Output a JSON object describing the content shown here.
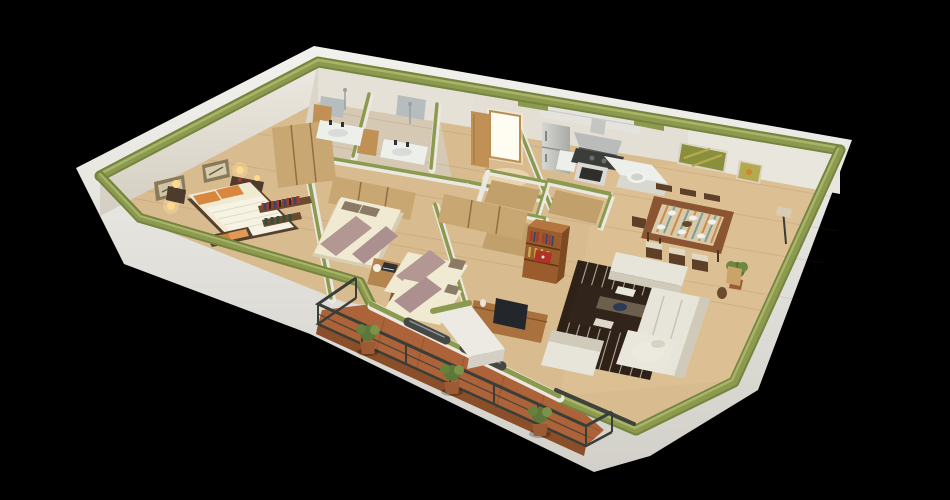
{
  "meta": {
    "description": "Photorealistic 3D isometric cutaway floor-plan rendering of a three-bedroom apartment viewed from above the south-west corner",
    "image_type": "3d-floorplan-render",
    "background": "solid black",
    "wall_treatment": "cut wall tops painted olive green, white wall faces, white plinth skirt around the slab",
    "visible_text": "none"
  },
  "palette": {
    "background": "#000000",
    "skirt_white": "#eae9e4",
    "skirt_shadow": "#d5d3cc",
    "wall_white": "#ebe8e1",
    "wall_face": "#e2ded3",
    "wall_top_green": "#8b9a4f",
    "wall_top_green_dark": "#75843e",
    "wall_top_green_light": "#a9b468",
    "floor_wood": "#d8bc90",
    "floor_wood_dining": "#e3c99e",
    "bath_floor": "#d5c9b4",
    "balcony_tile": "#ad6339",
    "balcony_tile_edge": "#8a4e28",
    "railing_metal": "#3a3e39",
    "rug_dark": "#2d2118",
    "rug_stripe": "#c9bda6",
    "sofa_white": "#e7e4da",
    "sofa_shadow": "#cfcaba",
    "coffee_table": "#31241a",
    "bookshelf_wood": "#9a5c2c",
    "sideboard_wood": "#a8713d",
    "tv_screen": "#23262b",
    "bed_mattress": "#f0ead2",
    "duvet_white": "#f7f3e4",
    "bed_throw_mauve": "#b29792",
    "pillow_orange": "#d8873e",
    "headboard_dark": "#55412f",
    "wardrobe_wood": "#c9a772",
    "wardrobe_trim": "#8f6f45",
    "desk_wood": "#b5854f",
    "door_wood": "#c09055",
    "door_glow": "#fffdf2",
    "appliance_steel": "#c9cac6",
    "appliance_dark": "#3b3d3a",
    "counter_white": "#edefeb",
    "mirror_gray": "#b6bdbf",
    "dining_table_wood": "#8a5530",
    "runner_cream": "#d9c9a8",
    "chair_seat": "#e2d9c2",
    "chair_wood": "#5d4027",
    "painting_green": "#8a8f3e",
    "painting_olive": "#b5a94f",
    "plant_green": "#5c7737",
    "plant_pot": "#9c5a35",
    "lamp_glow": "#ffd98f"
  },
  "rooms": [
    {
      "id": "master-bedroom",
      "name": "Master bedroom",
      "position": "upper left",
      "furniture": [
        "double bed with ribbed white duvet",
        "two orange pillows",
        "dark headboard",
        "bench with orange cushions at bed foot",
        "nightstand with lamp",
        "dresser with red books and lamp",
        "two framed pictures",
        "two lit wall sconces",
        "tall wardrobe",
        "wall shelves with colorful books"
      ]
    },
    {
      "id": "bathroom-1",
      "name": "Bathroom 1",
      "position": "top center-left",
      "furniture": [
        "white sink counter with dark faucet",
        "wall mirror",
        "shower fixture",
        "open wooden door"
      ]
    },
    {
      "id": "bathroom-2",
      "name": "Bathroom 2",
      "position": "top center",
      "furniture": [
        "white sink counter with dark faucet",
        "wall mirror",
        "shower fixture",
        "open wooden door"
      ]
    },
    {
      "id": "entry",
      "name": "Entry hall",
      "position": "top center-right",
      "furniture": [
        "open entry door with bright daylight glow",
        "wooden door panel",
        "hall closets with green-topped walls"
      ]
    },
    {
      "id": "kitchen",
      "name": "Kitchen",
      "position": "top right-center",
      "furniture": [
        "refrigerator",
        "range hood",
        "dark cooktop",
        "oven with dark window",
        "white counters with round sink",
        "upper cabinet band",
        "green-topped peninsula half wall"
      ]
    },
    {
      "id": "dining-area",
      "name": "Dining area",
      "position": "right",
      "furniture": [
        "wooden dining table with striped runner",
        "six white place settings",
        "six dark wood chairs with cream seats",
        "two olive-green abstract wall paintings",
        "potted plant",
        "floor lamp"
      ]
    },
    {
      "id": "bedroom-2",
      "name": "Bedroom 2",
      "position": "center-left",
      "furniture": [
        "double bed with two mauve throws",
        "double wardrobe",
        "desk with laptop and white lamp",
        "desk chair"
      ]
    },
    {
      "id": "bedroom-3",
      "name": "Bedroom 3",
      "position": "center",
      "furniture": [
        "two twin beds with mauve throws",
        "wardrobe",
        "closet enclosure"
      ]
    },
    {
      "id": "living-room",
      "name": "Living room",
      "position": "lower right",
      "furniture": [
        "L-shaped light grey sofa",
        "white armchair",
        "dark striped area rug",
        "dark wood coffee table with papers and navy bowl",
        "orange bookshelf with colorful books and red display book",
        "TV sideboard with television",
        "round white side table with bowl",
        "brown floor jug",
        "basket lamp"
      ]
    },
    {
      "id": "balcony",
      "name": "Balcony terrace",
      "position": "bottom",
      "furniture": [
        "terracotta tile floor",
        "dark metal railing with posts",
        "three potted shrubs",
        "white wall stub with green top",
        "dark sliding glass doors"
      ]
    }
  ]
}
